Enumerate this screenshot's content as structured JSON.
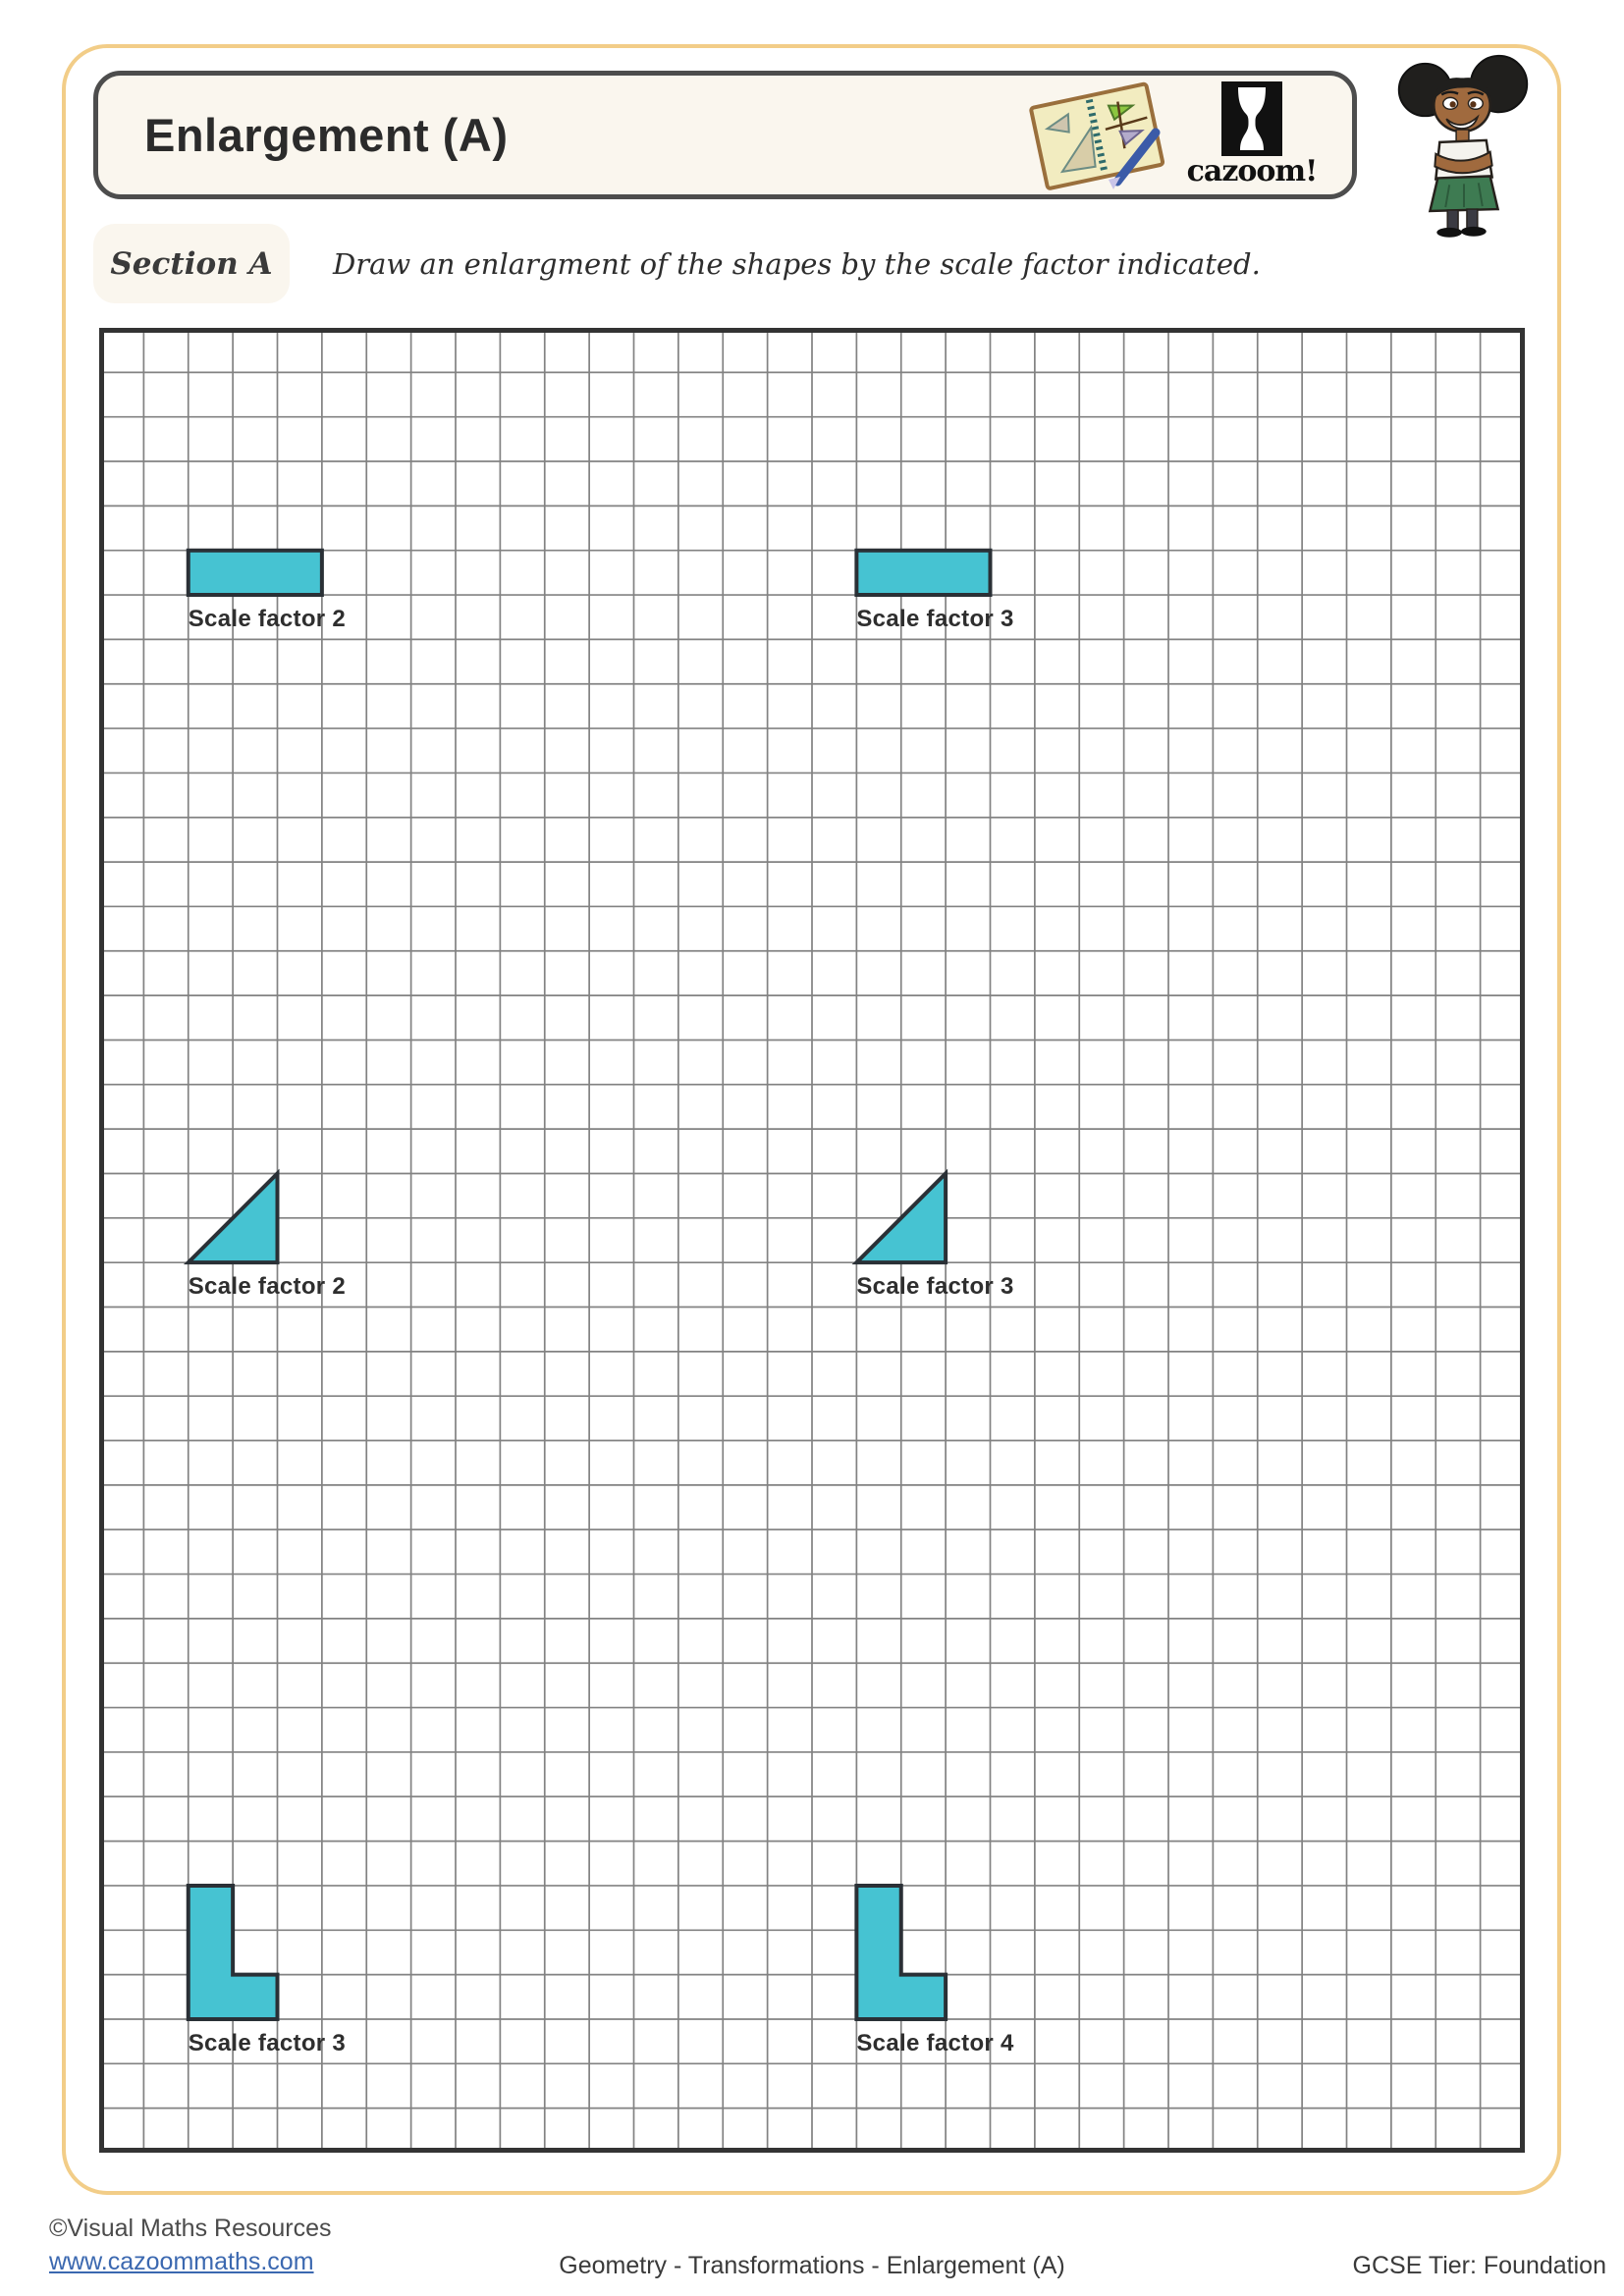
{
  "header": {
    "title": "Enlargement (A)",
    "logo_text": "cazoom!"
  },
  "section": {
    "label": "Section A",
    "instruction": "Draw an enlargment of the shapes by the scale factor indicated."
  },
  "worksheet": {
    "grid": {
      "cols": 32,
      "rows": 41
    },
    "colors": {
      "shape_fill": "#46C3D2",
      "shape_stroke": "#2A3036",
      "grid_line": "#828282",
      "grid_border": "#333333"
    },
    "problems": [
      {
        "shape": "rectangle",
        "label": "Scale factor 2",
        "cells_polygon": [
          [
            2,
            5
          ],
          [
            5,
            5
          ],
          [
            5,
            6
          ],
          [
            2,
            6
          ]
        ],
        "label_cell": [
          2,
          6
        ]
      },
      {
        "shape": "rectangle",
        "label": "Scale factor 3",
        "cells_polygon": [
          [
            17,
            5
          ],
          [
            20,
            5
          ],
          [
            20,
            6
          ],
          [
            17,
            6
          ]
        ],
        "label_cell": [
          17,
          6
        ]
      },
      {
        "shape": "right-triangle",
        "label": "Scale factor 2",
        "cells_polygon": [
          [
            2,
            21
          ],
          [
            4,
            19
          ],
          [
            4,
            21
          ]
        ],
        "label_cell": [
          2,
          21
        ]
      },
      {
        "shape": "right-triangle",
        "label": "Scale factor 3",
        "cells_polygon": [
          [
            17,
            21
          ],
          [
            19,
            19
          ],
          [
            19,
            21
          ]
        ],
        "label_cell": [
          17,
          21
        ]
      },
      {
        "shape": "l-shape",
        "label": "Scale factor 3",
        "cells_polygon": [
          [
            2,
            35
          ],
          [
            3,
            35
          ],
          [
            3,
            37
          ],
          [
            4,
            37
          ],
          [
            4,
            38
          ],
          [
            2,
            38
          ]
        ],
        "label_cell": [
          2,
          38
        ]
      },
      {
        "shape": "l-shape",
        "label": "Scale factor 4",
        "cells_polygon": [
          [
            17,
            35
          ],
          [
            18,
            35
          ],
          [
            18,
            37
          ],
          [
            19,
            37
          ],
          [
            19,
            38
          ],
          [
            17,
            38
          ]
        ],
        "label_cell": [
          17,
          38
        ]
      }
    ]
  },
  "footer": {
    "copyright": "©Visual Maths Resources",
    "website": "www.cazoommaths.com",
    "topic": "Geometry - Transformations - Enlargement (A)",
    "tier": "GCSE Tier: Foundation"
  }
}
